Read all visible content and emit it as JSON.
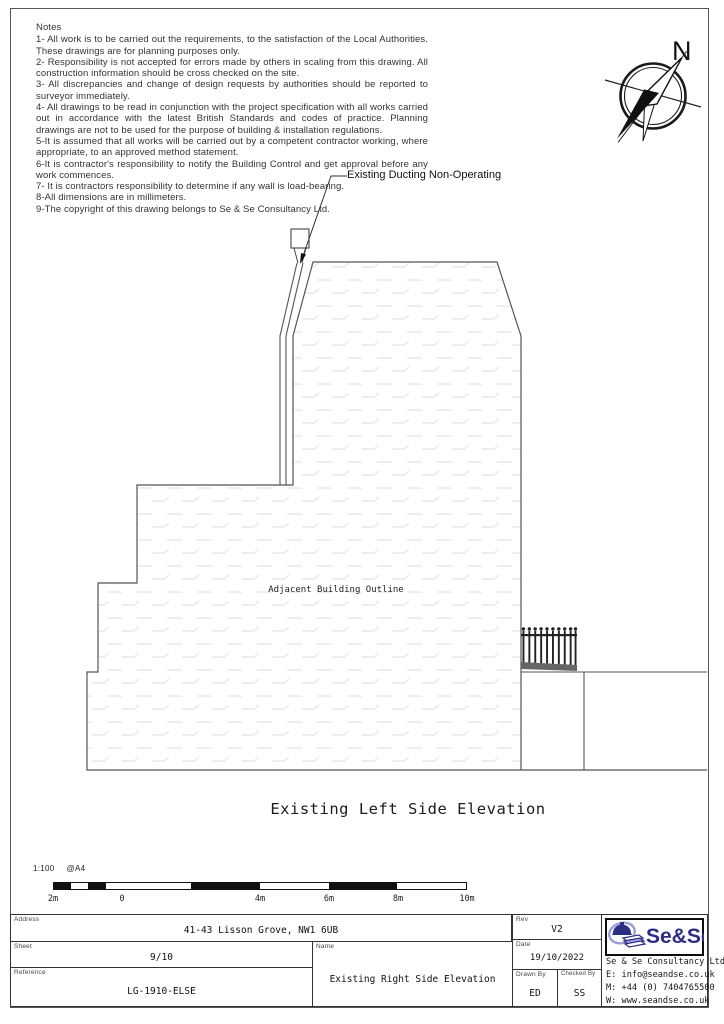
{
  "page": {
    "notes": {
      "heading": "Notes",
      "items": [
        "1- All work is to be carried out the requirements, to the satisfaction of the Local Authorities. These drawings are for planning purposes only.",
        "2- Responsibility is not accepted for errors made by others in scaling from this drawing. All construction information should be cross checked on the site.",
        "3- All discrepancies and change of design requests by authorities should be reported to surveyor immediately.",
        "4- All drawings to be read in conjunction with the project specification with all works carried out in accordance with the latest British Standards and codes of practice. Planning drawings are not to be used for the purpose of building & installation regulations.",
        "5-It is assumed that all works will be carried out by a competent contractor working, where appropriate, to an approved method statement.",
        "6-It is contractor's responsibility to notify the Building Control and get approval before any work commences.",
        "7- It is contractors responsibility to determine if any wall is load-bearing.",
        "8-All dimensions are in millimeters.",
        "9-The copyright of this drawing belongs to Se & Se Consultancy Ltd."
      ]
    },
    "compass": {
      "north_label": "N"
    },
    "drawing": {
      "duct_label": "Existing Ducting Non-Operating",
      "adjacent_label": "Adjacent Building Outline",
      "title": "Existing Left Side Elevation"
    },
    "scalebar": {
      "scale": "1:100",
      "paper": "@A4",
      "labels": [
        "2m",
        "0",
        "4m",
        "6m",
        "8m",
        "10m"
      ]
    },
    "titleblock": {
      "address": {
        "label": "Address",
        "value": "41-43 Lisson Grove, NW1 6UB"
      },
      "sheet": {
        "label": "Sheet",
        "value": "9/10"
      },
      "reference": {
        "label": "Reference",
        "value": "LG-1910-ELSE"
      },
      "name": {
        "label": "Name",
        "value": "Existing Right Side Elevation"
      },
      "rev": {
        "label": "Rev",
        "value": "V2"
      },
      "date": {
        "label": "Date",
        "value": "19/10/2022"
      },
      "drawn": {
        "label": "Drawn By",
        "value": "ED"
      },
      "checked": {
        "label": "Checked By",
        "value": "SS"
      },
      "company": {
        "logo_text": "Se&Se",
        "name": "Se & Se Consultancy Ltd.",
        "email": "E: info@seandse.co.uk",
        "mobile": "M: +44 (0) 7404765500",
        "web": "W: www.seandse.co.uk"
      }
    },
    "colors": {
      "line": "#555555",
      "hatch": "#e8e8e8",
      "brand_navy": "#2b2e83",
      "brand_periwinkle": "#9aa0d8"
    }
  }
}
